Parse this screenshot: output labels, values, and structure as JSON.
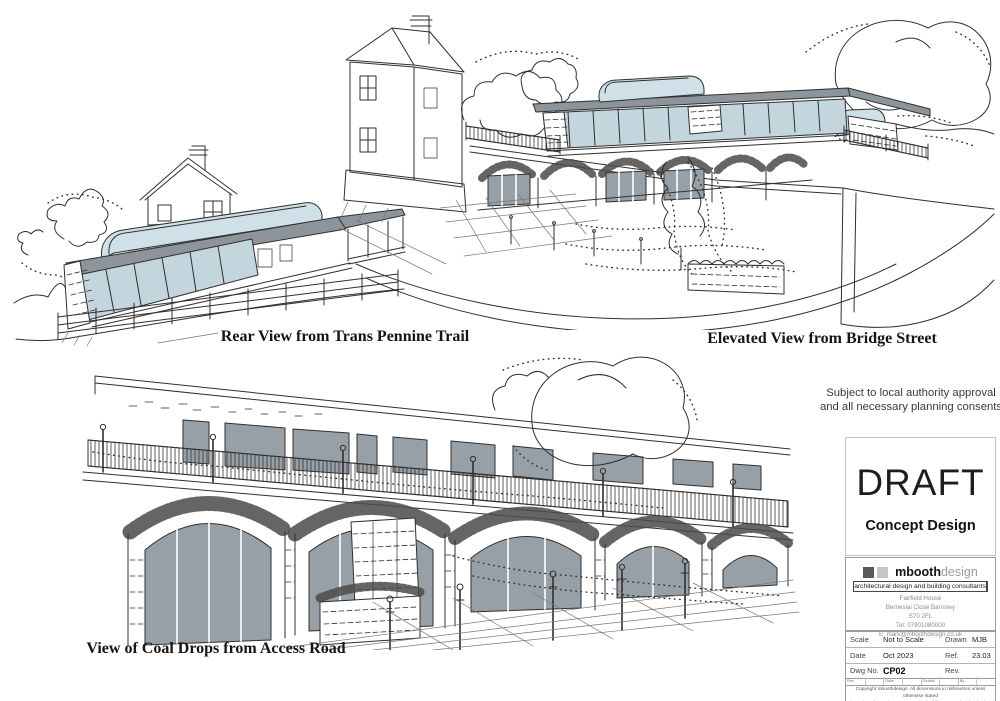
{
  "sketches": {
    "rear_view": {
      "caption": "Rear View from Trans Pennine Trail"
    },
    "elevated_view": {
      "caption": "Elevated View from Bridge Street"
    },
    "coal_drops": {
      "caption": "View of Coal Drops from Access Road"
    }
  },
  "title_block": {
    "approval_note": "Subject to local authority approval and all necessary planning consents",
    "status": "DRAFT",
    "stage": "Concept Design",
    "firm": {
      "name_bold": "mbooth",
      "name_light": "design",
      "tagline": "architectural design and building consultants",
      "address_lines": [
        "Fairfield House",
        "Berneslai Close Barnsley",
        "S70 2FL",
        "Tel: 07901080000",
        "E: mark@mboothdesign.co.uk"
      ]
    },
    "info_table": {
      "rows": [
        {
          "label1": "Scale",
          "value1": "Not to Scale",
          "label2": "Drawn",
          "value2": "MJB"
        },
        {
          "label1": "Date",
          "value1": "Oct 2023",
          "label2": "Ref.",
          "value2": "23.03"
        },
        {
          "label1": "Dwg No.",
          "value1": "CP02",
          "label2": "Rev.",
          "value2": ""
        }
      ]
    },
    "revision_strip": [
      "Rev",
      "Date",
      "Details",
      "By"
    ],
    "copyright_lines": [
      "Copyright mboothdesign. All dimensions in millimetres unless otherwise stated",
      "Dimensions for setting out in existing buildings are to be checked and verified on site"
    ]
  },
  "colors": {
    "ink": "#2f2f2f",
    "roof_gray": "#8d949a",
    "glass_blue": "#c3d6de",
    "rooflight_blue": "#cfe0e8",
    "door_gray": "#98a0a7",
    "paper": "#ffffff"
  }
}
